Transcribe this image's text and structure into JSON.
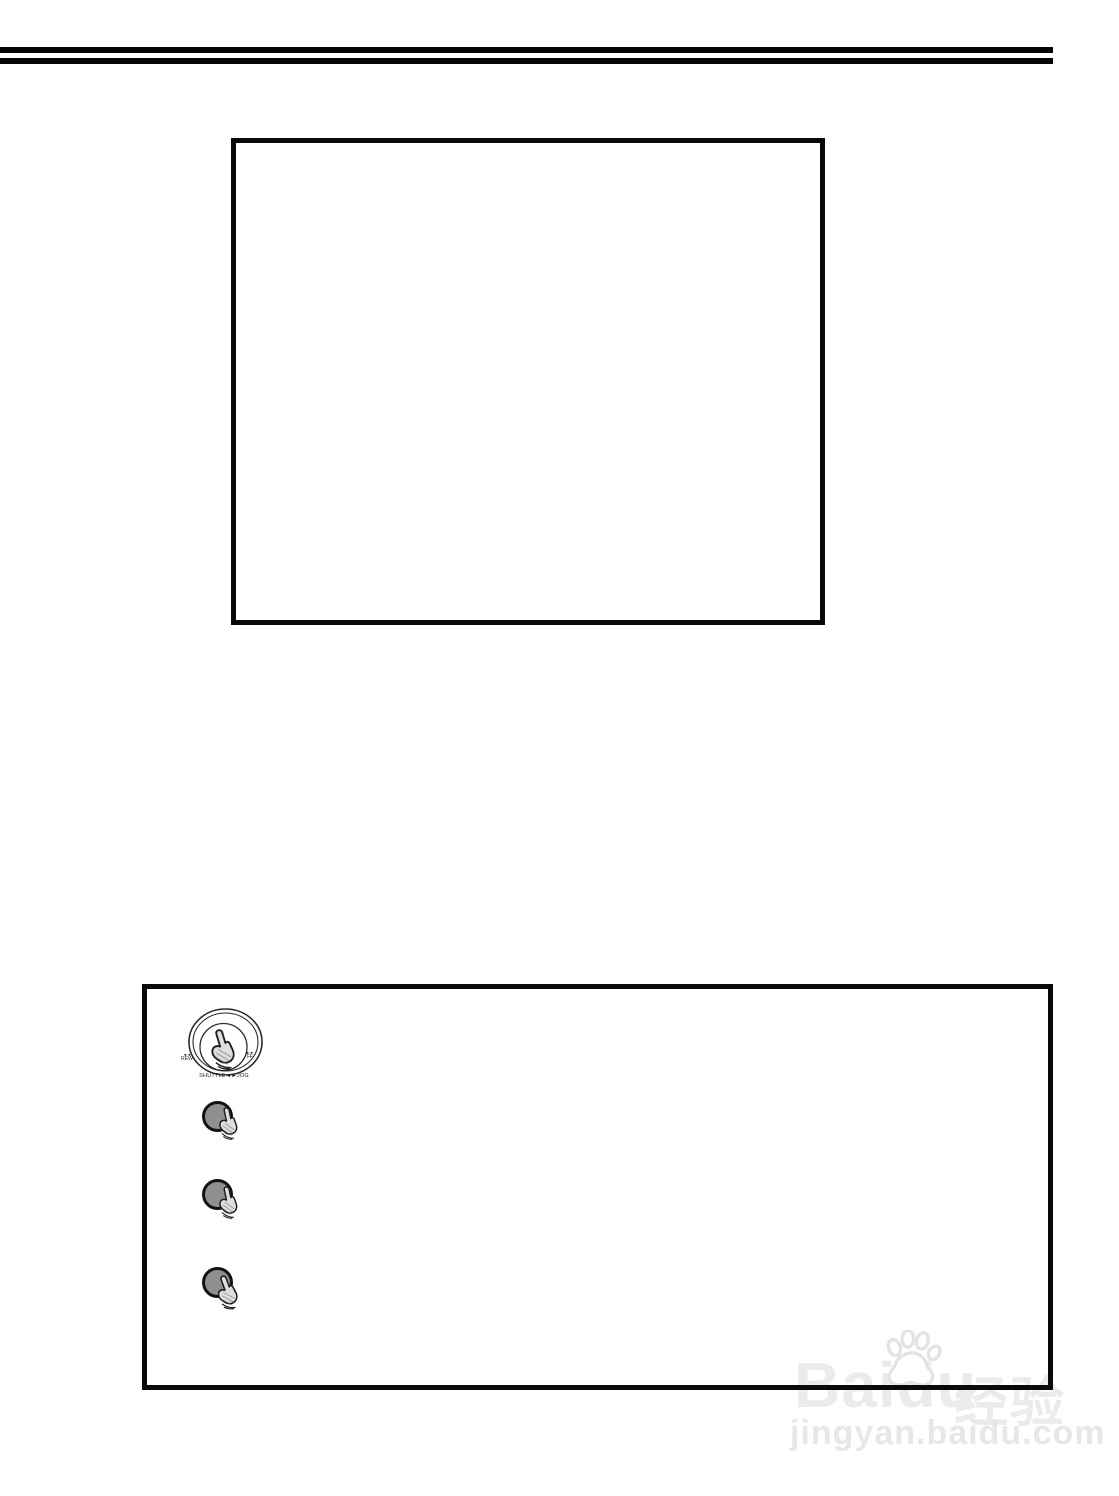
{
  "colors": {
    "ink": "#0a0a0a",
    "button_fill": "#8f8f8f",
    "hand_fill": "#dedede",
    "watermark_text": "#ebebeb",
    "watermark_url": "#e7e7e7"
  },
  "panel": {
    "dial": {
      "left_arrows": "◄◄",
      "left_label": "REW",
      "right_arrows": "►►",
      "right_label": "FF",
      "caption": "SHUTTLE◄►JOG"
    }
  },
  "watermark": {
    "brand": "Baidu",
    "brand_cn": "经验",
    "url": "jingyan.baidu.com"
  }
}
